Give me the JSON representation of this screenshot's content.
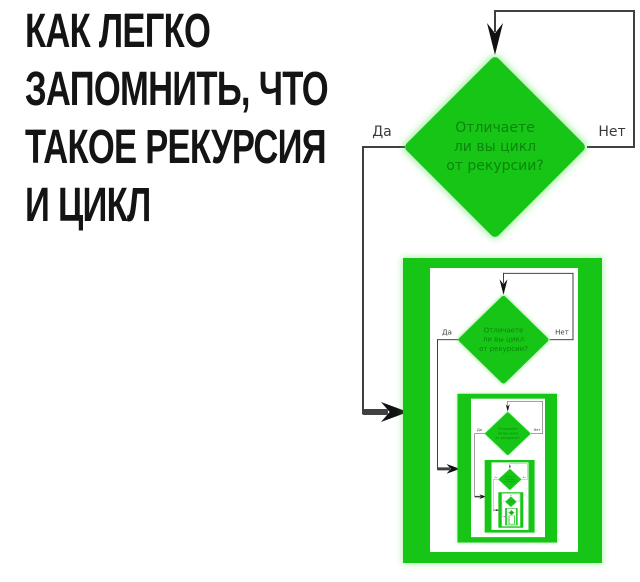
{
  "title": {
    "lines": [
      "КАК ЛЕГКО",
      "ЗАПОМНИТЬ, ЧТО",
      "ТАКОЕ РЕКУРСИЯ",
      "И ЦИКЛ"
    ],
    "full_text": "КАК ЛЕГКО ЗАПОМНИТЬ, ЧТО ТАКОЕ РЕКУРСИЯ И ЦИКЛ"
  },
  "flowchart": {
    "question_lines": [
      "Отличаете",
      "ли вы цикл",
      "от рекурсии?"
    ],
    "question_full": "Отличаете ли вы цикл от рекурсии?",
    "yes_label": "Да",
    "no_label": "Нет",
    "nesting_levels": 6
  },
  "colors": {
    "green": "#16c516",
    "question_text": "#0b860b",
    "connector": "#404040",
    "label_text": "#3a3a3a",
    "title_text": "#141414",
    "background": "#ffffff"
  }
}
